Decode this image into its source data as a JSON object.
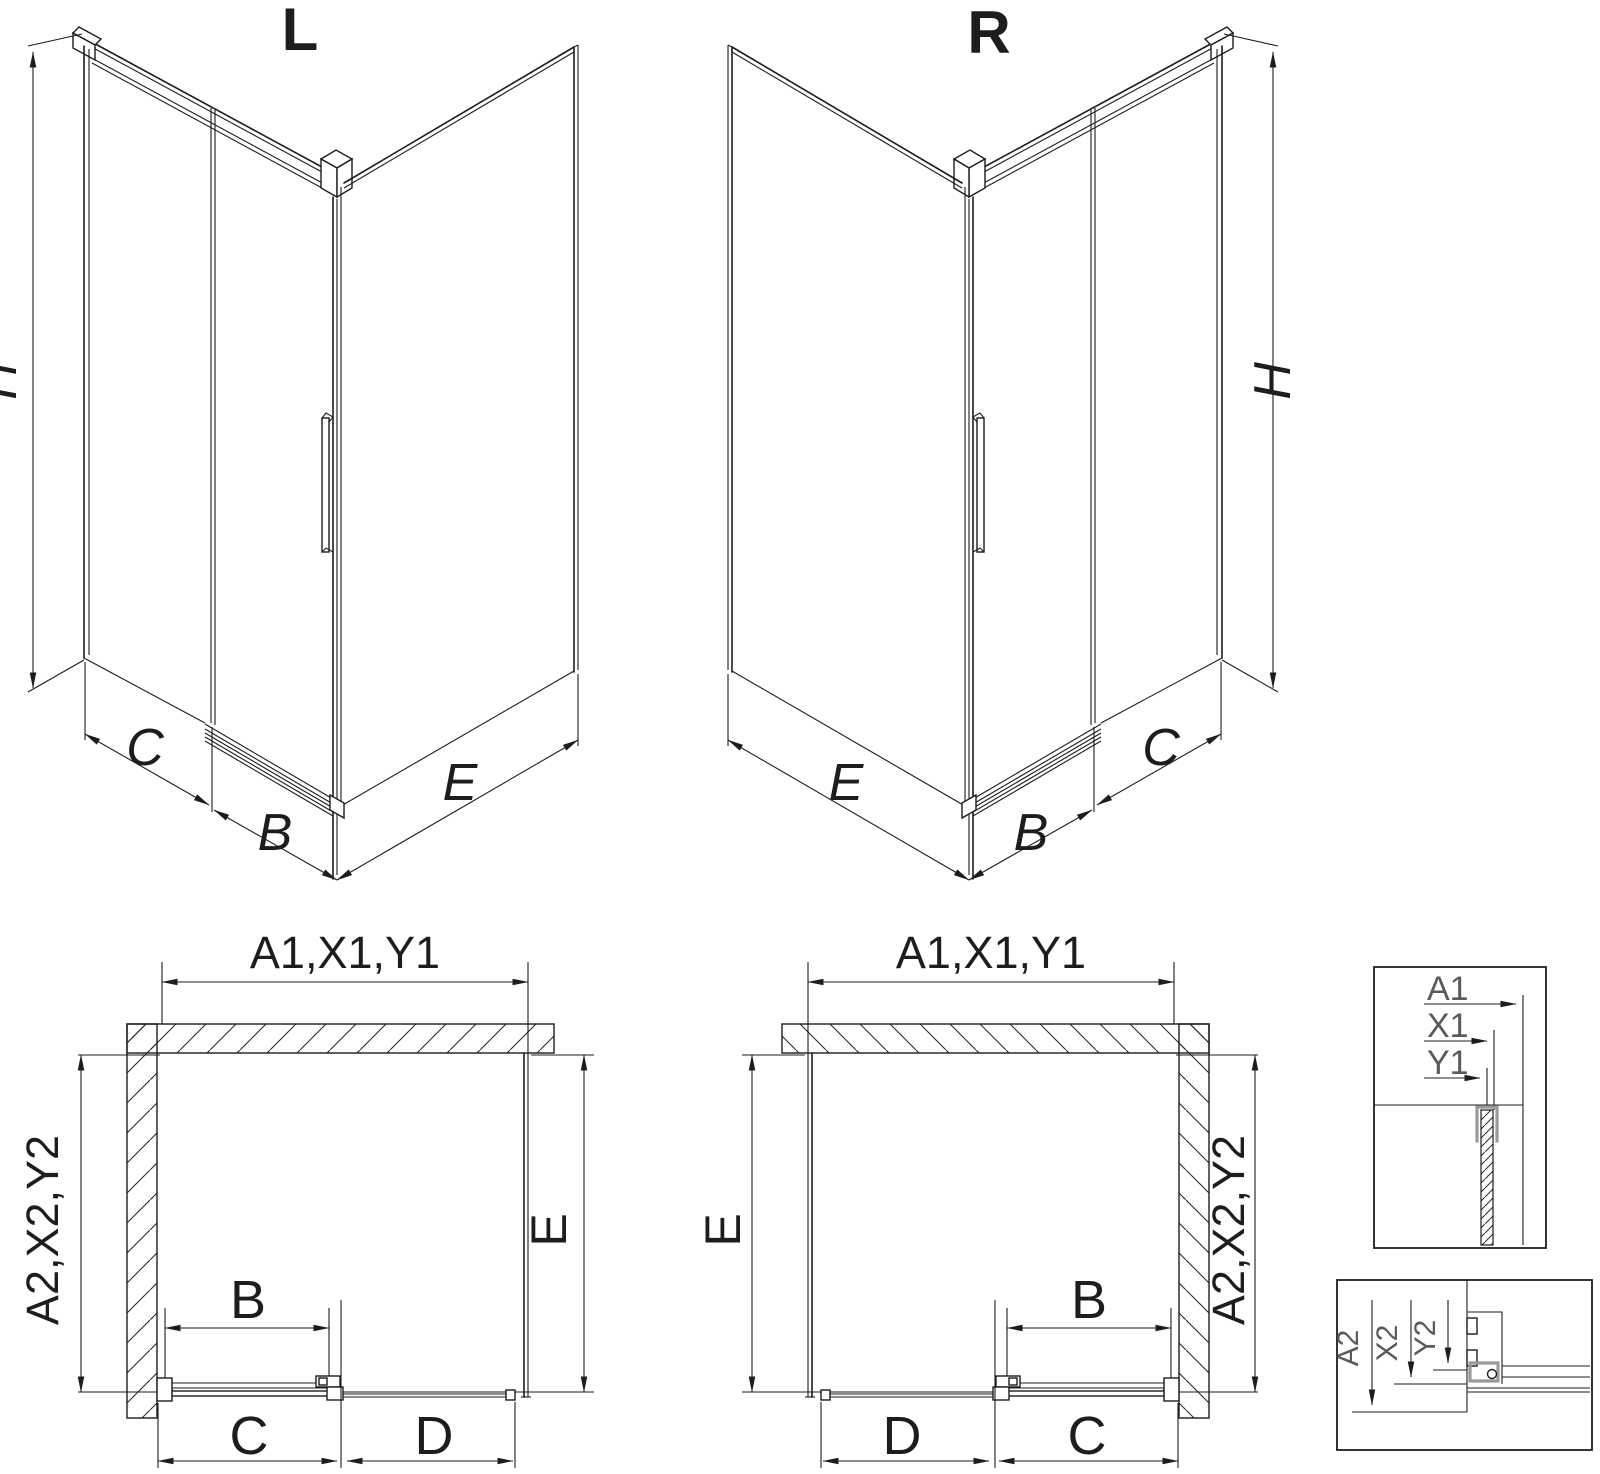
{
  "drawing": {
    "subject": "corner shower enclosure with sliding door, left and right versions",
    "line_color": "#1d1d1d",
    "detail_label_color": "#5a5a5a",
    "highlight_color": "#9a9a9a",
    "background": "#ffffff"
  },
  "iso_left": {
    "variant": "L",
    "dim_height": "H",
    "dim_fixed_width": "C",
    "dim_door_width": "B",
    "dim_side_width": "E"
  },
  "iso_right": {
    "variant": "R",
    "dim_height": "H",
    "dim_fixed_width": "C",
    "dim_door_width": "B",
    "dim_side_width": "E"
  },
  "plan_left": {
    "dim_top": "A1,X1,Y1",
    "dim_side_wall": "A2,X2,Y2",
    "dim_depth": "E",
    "dim_door": "B",
    "dim_bottom_inner": "C",
    "dim_bottom_outer": "D"
  },
  "plan_right": {
    "dim_top": "A1,X1,Y1",
    "dim_side_wall": "A2,X2,Y2",
    "dim_depth": "E",
    "dim_door": "B",
    "dim_bottom_inner": "C",
    "dim_bottom_outer": "D"
  },
  "detail_top": {
    "label_a1": "A1",
    "label_x1": "X1",
    "label_y1": "Y1"
  },
  "detail_bottom": {
    "label_a2": "A2",
    "label_x2": "X2",
    "label_y2": "Y2"
  }
}
